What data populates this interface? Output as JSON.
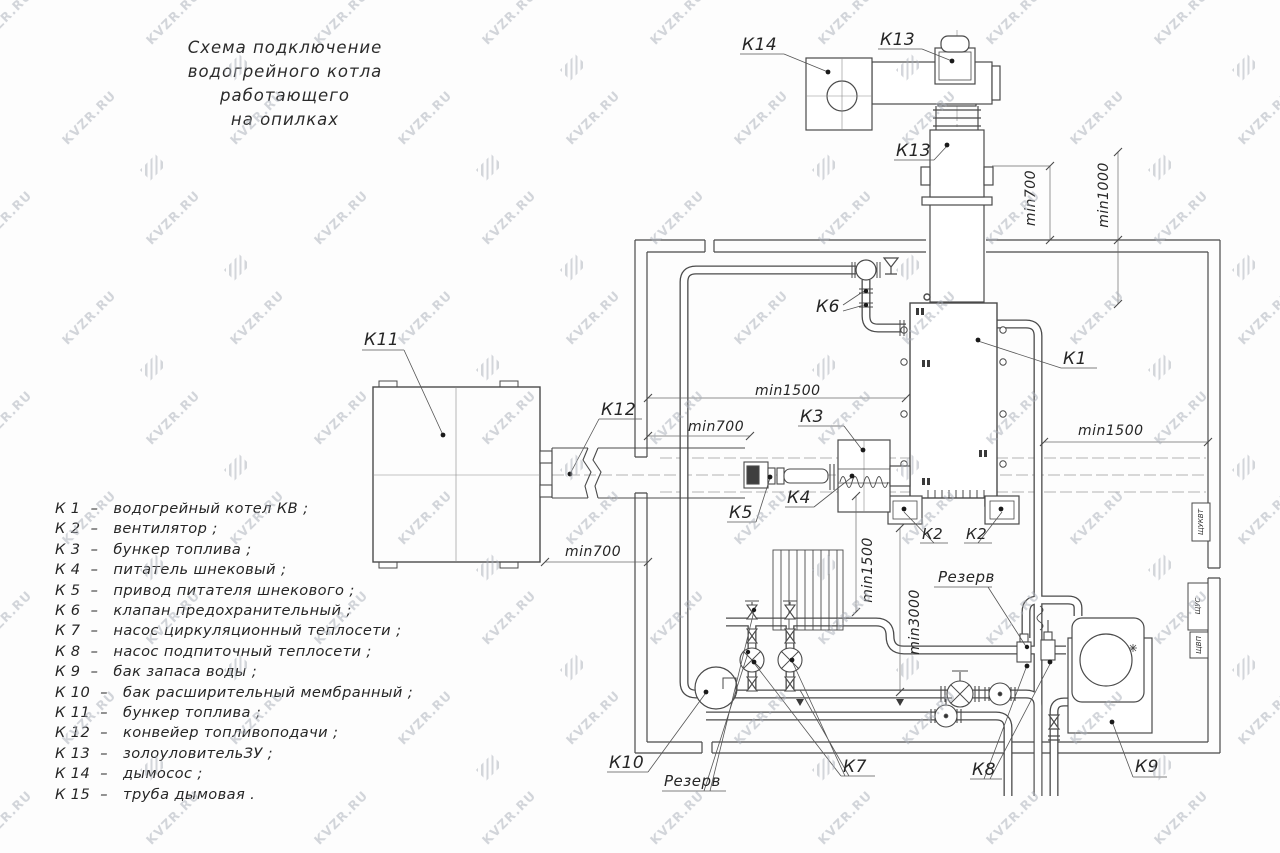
{
  "title": {
    "line1": "Схема подключение",
    "line2": "водогрейного котла работающего",
    "line3": "на опилках"
  },
  "legend": {
    "items": [
      "К 1  –   водогрейный котел КВ ;",
      "К 2  –   вентилятор ;",
      "К 3  –   бункер топлива ;",
      "К 4  –   питатель шнековый ;",
      "К 5  –   привод питателя шнекового ;",
      "К 6  –   клапан предохранительный ;",
      "К 7  –   насос циркуляционный теплосети ;",
      "К 8  –   насос подпиточный теплосети ;",
      "К 9  –   бак запаса воды ;",
      "К 10  –   бак расширительный мембранный ;",
      "К 11  –   бункер топлива ;",
      "К 12  –   конвейер топливоподачи ;",
      "К 13  –   золоуловительЗУ ;",
      "К 14  –   дымосос ;",
      "К 15  –   труба дымовая ."
    ]
  },
  "diagram": {
    "labels": {
      "k1": "К1",
      "k2_left": "К2",
      "k2_right": "К2",
      "k3": "К3",
      "k4": "К4",
      "k5": "К5",
      "k6": "К6",
      "k7": "К7",
      "k8": "К8",
      "k9": "К9",
      "k10": "К10",
      "k11": "К11",
      "k12": "К12",
      "k13_top": "К13",
      "k13_mid": "К13",
      "k14": "К14"
    },
    "dimensions": {
      "top_700": "min700",
      "top_1000": "min1000",
      "left_1500": "min1500",
      "left_700": "min700",
      "right_1500": "min1500",
      "bottom_700": "min700",
      "vert_1500": "min1500",
      "vert_3000": "min3000"
    },
    "annotations": {
      "reserve_left": "Резерв",
      "reserve_right": "Резерв"
    },
    "panels": {
      "p1": "ЩУКВТ",
      "p2": "ЩУС",
      "p3": "ЩВП"
    }
  },
  "watermark": {
    "text": "KVZR.RU"
  },
  "colors": {
    "line": "#4a4a4a",
    "text": "#262626",
    "watermark": "#a9aeb8"
  }
}
